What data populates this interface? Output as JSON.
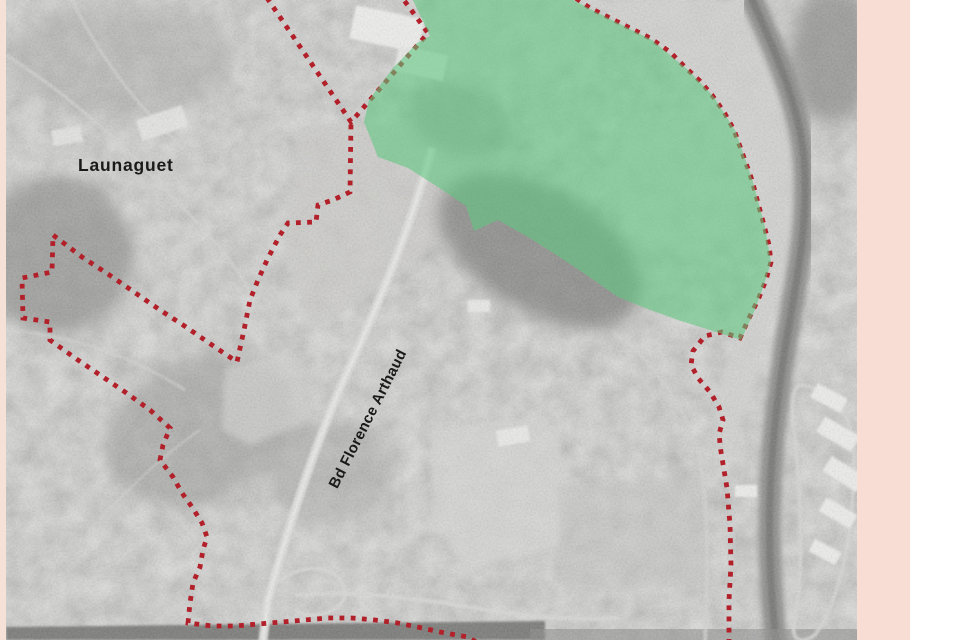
{
  "page": {
    "background": "#ffffff"
  },
  "margins": {
    "left_strip_color": "#f5e1d6",
    "right_band_color": "#f8ddd5"
  },
  "map": {
    "labels": {
      "place": "Launaguet",
      "road": "Bd Florence Arthaud"
    },
    "colors": {
      "boundary_red": "#b2202a",
      "zone_green_fill": "#5fc880",
      "zone_green_opacity": 0.58,
      "photo_base": "#bcbcba",
      "label_color": "#1a1a1a"
    },
    "boundary_paths": [
      [
        [
          398,
          -8
        ],
        [
          428,
          33
        ],
        [
          351,
          122
        ],
        [
          263,
          -8
        ]
      ],
      [
        [
          567,
          -8
        ],
        [
          590,
          8
        ],
        [
          620,
          23
        ],
        [
          650,
          38
        ],
        [
          670,
          52
        ],
        [
          686,
          68
        ],
        [
          700,
          81
        ],
        [
          712,
          95
        ],
        [
          724,
          112
        ],
        [
          734,
          130
        ],
        [
          742,
          152
        ],
        [
          752,
          180
        ],
        [
          758,
          203
        ],
        [
          764,
          225
        ],
        [
          769,
          245
        ],
        [
          771,
          262
        ],
        [
          766,
          280
        ],
        [
          758,
          300
        ],
        [
          748,
          320
        ],
        [
          740,
          338
        ],
        [
          722,
          332
        ],
        [
          705,
          336
        ],
        [
          693,
          351
        ],
        [
          691,
          365
        ],
        [
          698,
          378
        ],
        [
          710,
          392
        ],
        [
          719,
          407
        ],
        [
          723,
          420
        ],
        [
          719,
          434
        ],
        [
          721,
          452
        ],
        [
          727,
          488
        ],
        [
          730,
          525
        ],
        [
          731,
          565
        ],
        [
          729,
          600
        ],
        [
          729,
          648
        ]
      ],
      [
        [
          485,
          648
        ],
        [
          468,
          637
        ],
        [
          445,
          633
        ],
        [
          422,
          628
        ],
        [
          398,
          623
        ],
        [
          375,
          620
        ],
        [
          352,
          618
        ],
        [
          328,
          618
        ],
        [
          305,
          620
        ],
        [
          282,
          622
        ],
        [
          258,
          624
        ],
        [
          235,
          626
        ],
        [
          212,
          626
        ],
        [
          188,
          623
        ],
        [
          190,
          603
        ],
        [
          193,
          583
        ],
        [
          200,
          567
        ],
        [
          203,
          550
        ],
        [
          207,
          537
        ],
        [
          202,
          523
        ],
        [
          192,
          507
        ],
        [
          182,
          493
        ],
        [
          173,
          477
        ],
        [
          160,
          460
        ],
        [
          163,
          445
        ],
        [
          170,
          428
        ],
        [
          150,
          410
        ],
        [
          125,
          392
        ],
        [
          100,
          375
        ],
        [
          75,
          358
        ],
        [
          50,
          340
        ],
        [
          50,
          322
        ],
        [
          23,
          318
        ],
        [
          22,
          278
        ],
        [
          52,
          272
        ],
        [
          53,
          235
        ],
        [
          82,
          257
        ],
        [
          108,
          274
        ],
        [
          134,
          292
        ],
        [
          160,
          310
        ],
        [
          186,
          327
        ],
        [
          212,
          345
        ],
        [
          237,
          362
        ],
        [
          244,
          330
        ],
        [
          250,
          300
        ],
        [
          258,
          280
        ],
        [
          268,
          258
        ],
        [
          280,
          235
        ],
        [
          288,
          223
        ],
        [
          316,
          222
        ],
        [
          318,
          205
        ],
        [
          333,
          200
        ],
        [
          350,
          192
        ],
        [
          351,
          122
        ]
      ]
    ],
    "green_zone_points": [
      [
        410,
        -6
      ],
      [
        562,
        -6
      ],
      [
        592,
        10
      ],
      [
        622,
        25
      ],
      [
        652,
        40
      ],
      [
        688,
        70
      ],
      [
        714,
        97
      ],
      [
        736,
        132
      ],
      [
        753,
        182
      ],
      [
        765,
        227
      ],
      [
        771,
        262
      ],
      [
        764,
        285
      ],
      [
        754,
        312
      ],
      [
        741,
        340
      ],
      [
        710,
        330
      ],
      [
        678,
        320
      ],
      [
        645,
        308
      ],
      [
        618,
        297
      ],
      [
        588,
        276
      ],
      [
        558,
        256
      ],
      [
        528,
        237
      ],
      [
        498,
        220
      ],
      [
        474,
        231
      ],
      [
        466,
        206
      ],
      [
        438,
        187
      ],
      [
        408,
        168
      ],
      [
        378,
        157
      ],
      [
        364,
        122
      ],
      [
        369,
        100
      ],
      [
        393,
        68
      ],
      [
        417,
        43
      ],
      [
        430,
        36
      ]
    ]
  }
}
